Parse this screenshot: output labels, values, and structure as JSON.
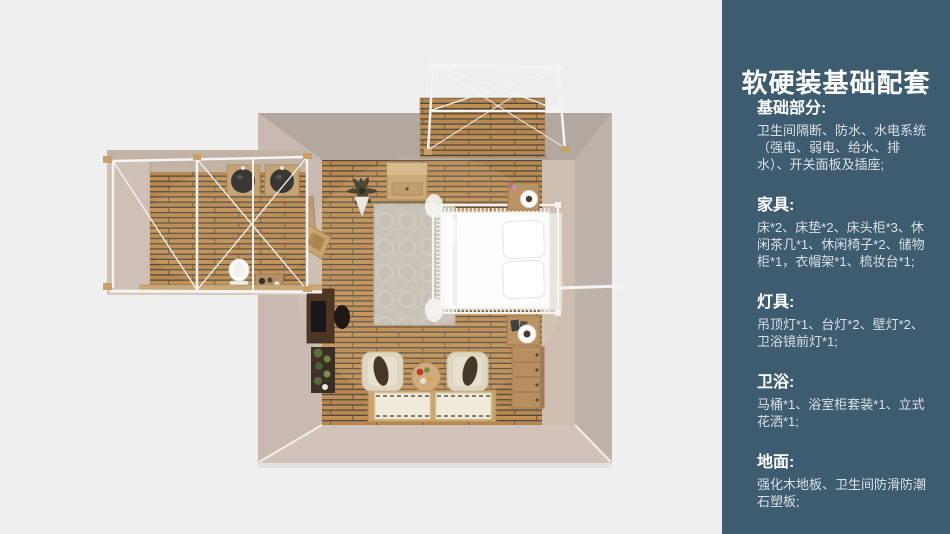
{
  "slide": {
    "background": "#f0eff0"
  },
  "panel": {
    "background": "#3e5c6f",
    "title": "软硬装基础配套",
    "sections": [
      {
        "heading": "基础部分:",
        "body": "卫生间隔断、防水、水电系统（强电、弱电、给水、排水）、开关面板及插座;"
      },
      {
        "heading": "家具:",
        "body": "床*2、床垫*2、床头柜*3、休闲茶几*1、休闲椅子*2、储物柜*1，衣帽架*1、梳妆台*1;"
      },
      {
        "heading": "灯具:",
        "body": "吊顶灯*1、台灯*2、壁灯*2、卫浴镜前灯*1;"
      },
      {
        "heading": "卫浴:",
        "body": "马桶*1、浴室柜套装*1、立式花洒*1;"
      },
      {
        "heading": "地面:",
        "body": "强化木地板、卫生间防滑防潮石塑板;"
      }
    ]
  },
  "floorplan": {
    "palette": {
      "wall_outer": "#b3a89f",
      "wall_inner": "#d4c5b7",
      "wood_plank": "#c08f55",
      "wood_gap": "#4e4a42",
      "frame_white": "#f5f4f2",
      "bed_white": "#fafaf9",
      "rug": "#c9c2b9"
    }
  }
}
